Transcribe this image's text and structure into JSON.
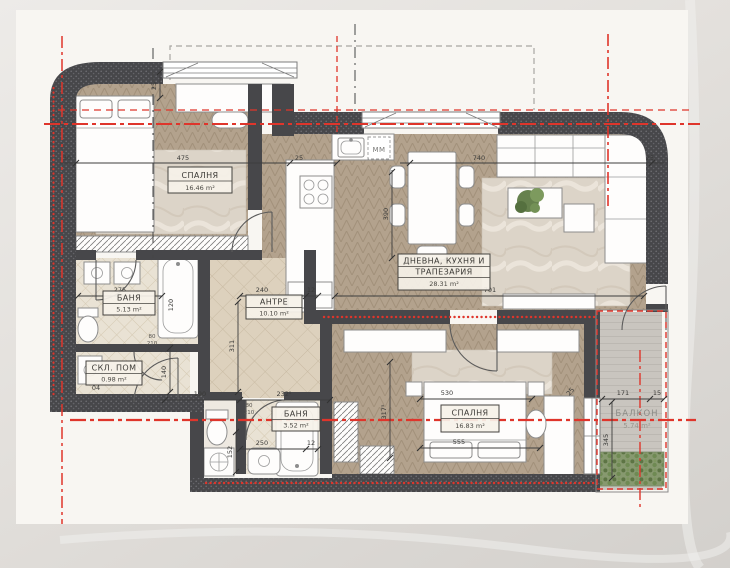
{
  "title": "Apartment floor plan",
  "colors": {
    "wall": "#47474a",
    "red": "#df352b",
    "wood": "#b3a28d",
    "tile": "#ddd1bd",
    "deck": "#c9c5bf",
    "paper": "#f8f6f2"
  },
  "rooms": {
    "bedroom1": {
      "name": "СПАЛНЯ",
      "area": "16.46 m²"
    },
    "living": {
      "name_line1": "ДНЕВНА, КУХНЯ И",
      "name_line2": "ТРАПЕЗАРИЯ",
      "area": "28.31 m²"
    },
    "entry": {
      "name": "АНТРЕ",
      "area": "10.10 m²"
    },
    "bath1": {
      "name": "БАНЯ",
      "area": "5.13 m²"
    },
    "storage": {
      "name": "СКЛ. ПОМ",
      "area": "0.98 m²"
    },
    "bath2": {
      "name": "БАНЯ",
      "area": "3.52 m²"
    },
    "bedroom2": {
      "name": "СПАЛНЯ",
      "area": "16.83 m²"
    },
    "balcony": {
      "name": "БАЛКОН",
      "area": "5.74 m²"
    }
  },
  "labels": {
    "appliance": "ММ"
  },
  "dims": {
    "bedroom1_width": "475",
    "left_niche": "30",
    "wall_thick_a": "25",
    "wall_thick_b": "25",
    "living_width": "740",
    "wall_thick_c": "25",
    "kitchen_depth": "390",
    "living_south": "701",
    "entry_width": "240",
    "partition_a": "12",
    "bath1_width": "275",
    "shaft": "120",
    "entry_depth": "311",
    "hall_a": "140",
    "hall_b": "190",
    "hall_c": "232⁵",
    "tiny": "04",
    "bath2_width": "250",
    "partition_b": "12",
    "bath2_depth": "152",
    "bed2_width": "530",
    "bed2_width2": "555",
    "bed2_depth": "317⁵",
    "balcony_width": "171",
    "balcony_edge": "15",
    "balcony_depth": "345",
    "wall_thick_d": "25",
    "door_w": "80",
    "door_h": "210"
  }
}
